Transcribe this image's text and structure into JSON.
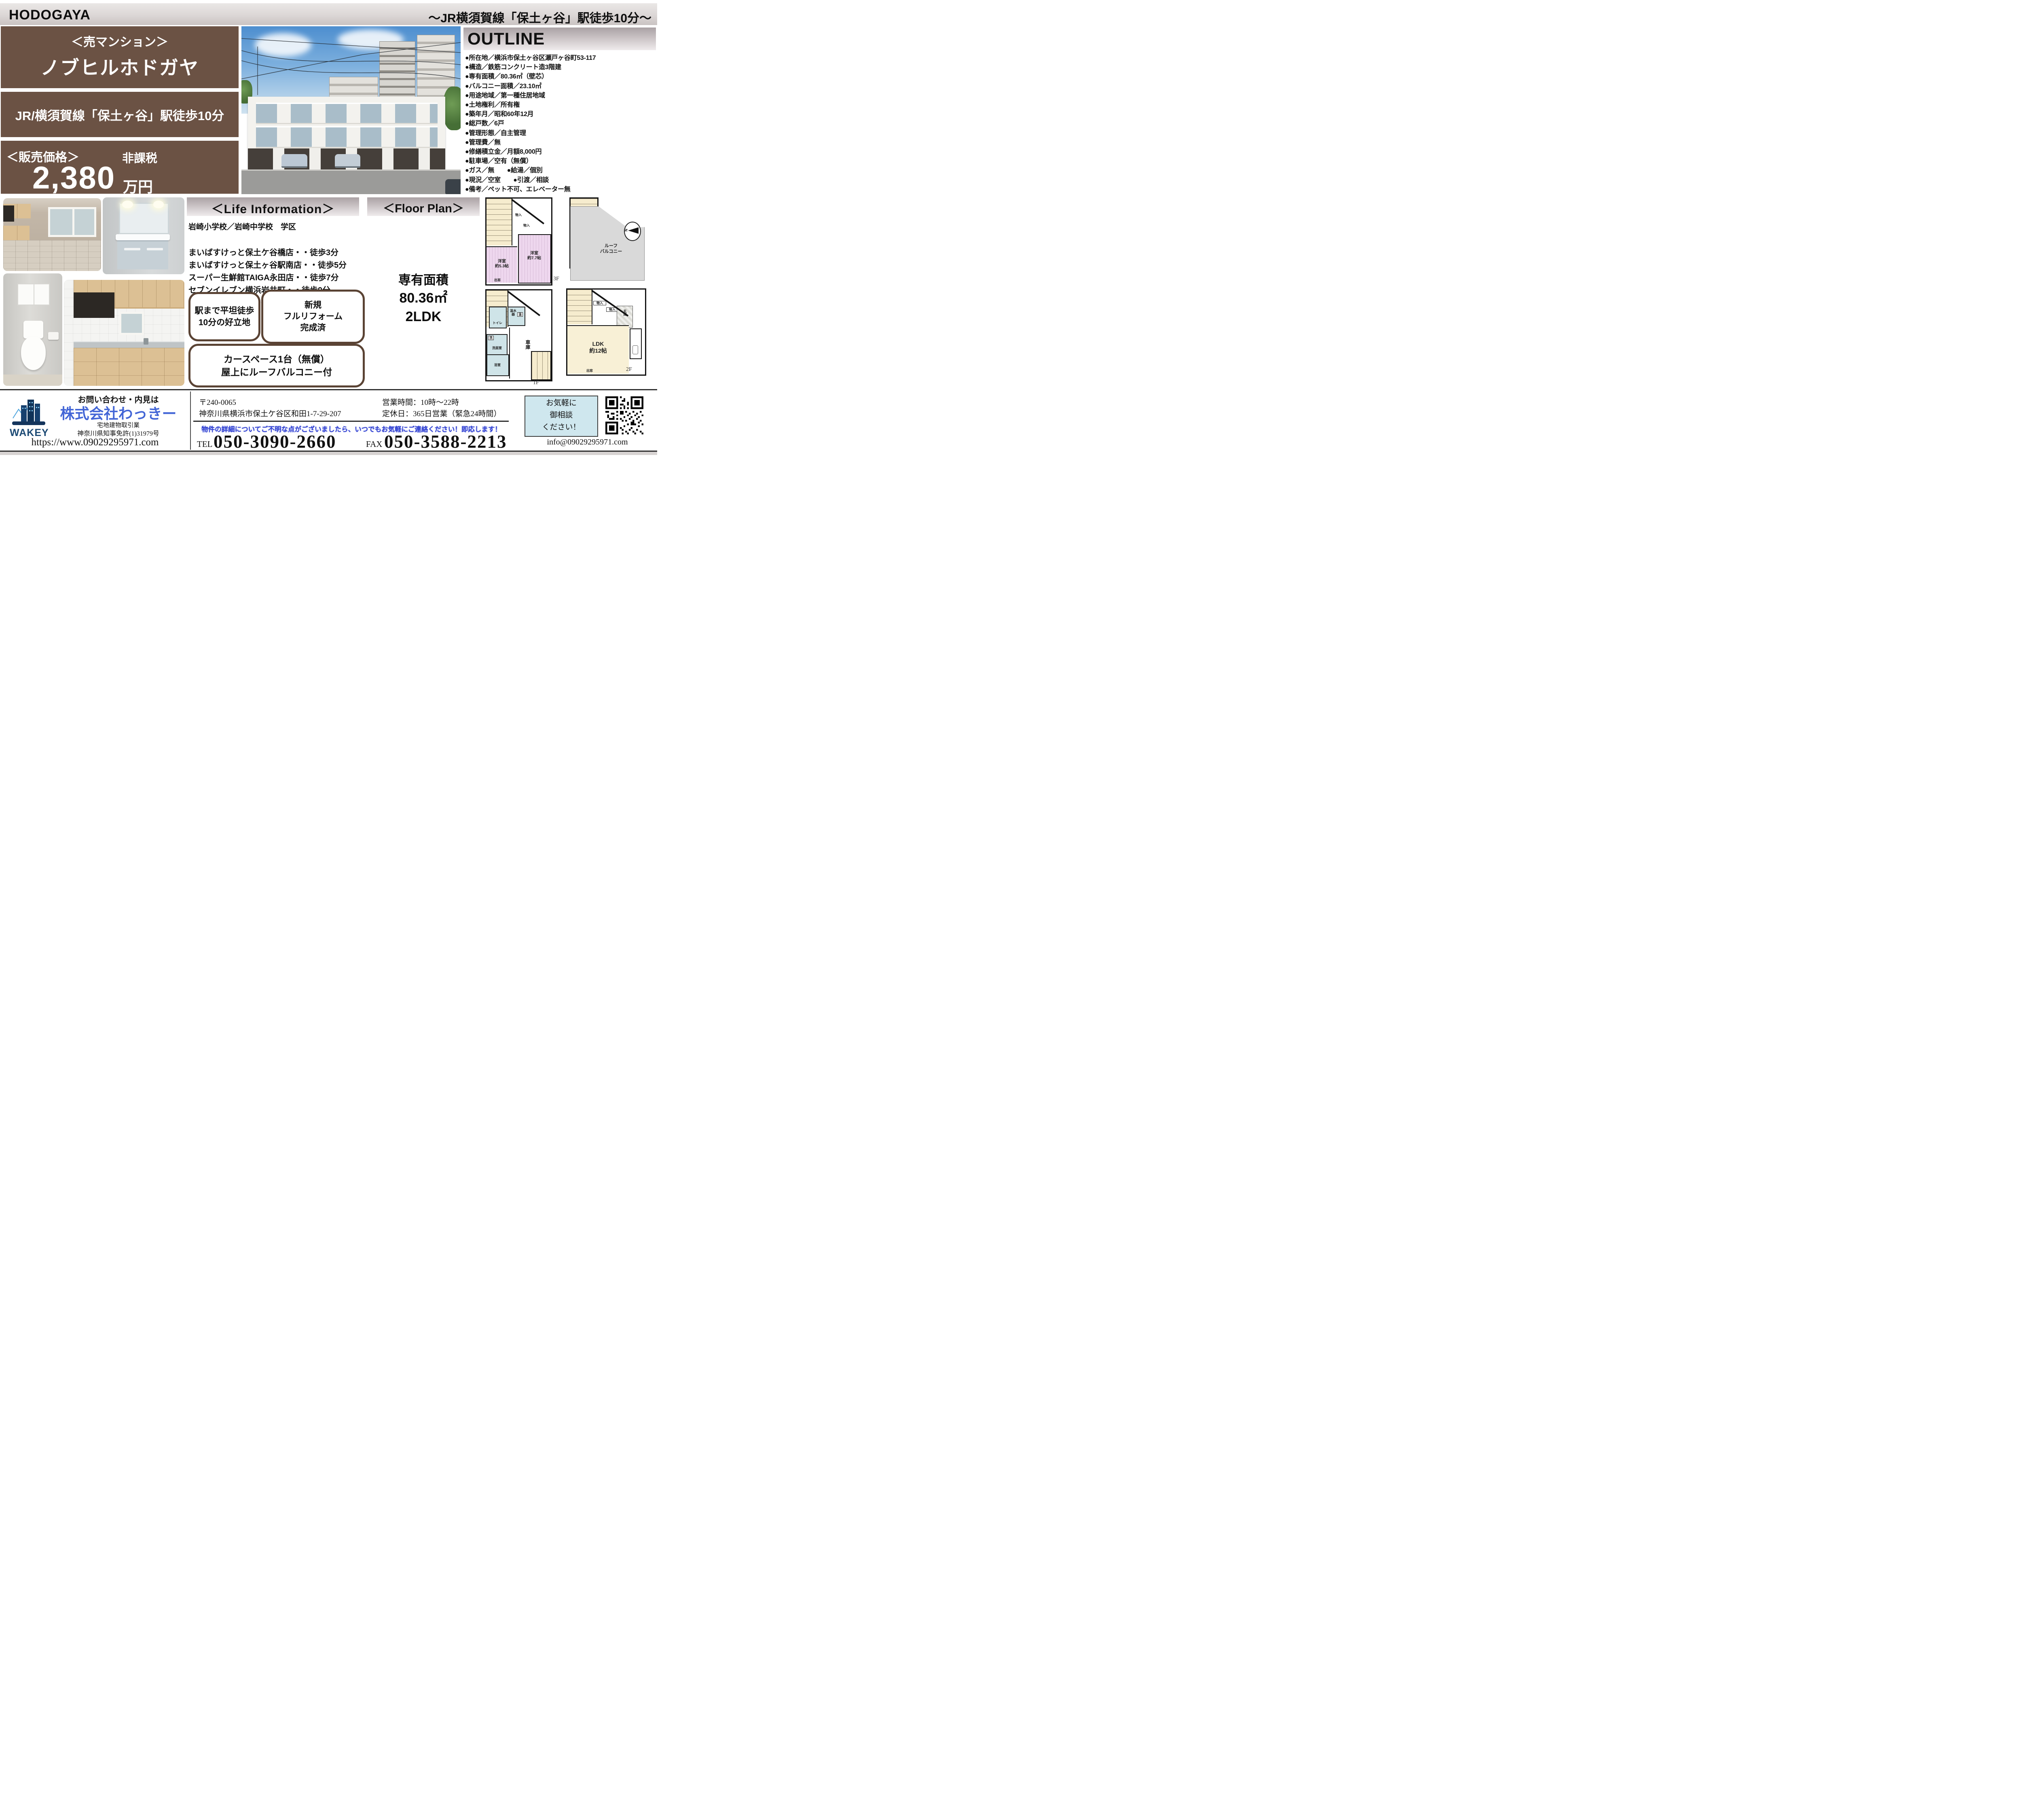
{
  "header": {
    "brand": "HODOGAYA",
    "station_note": "～JR横須賀線「保土ヶ谷」駅徒歩10分～"
  },
  "property": {
    "type_label": "＜売マンション＞",
    "name": "ノブヒルホドガヤ",
    "access": "JR/横須賀線「保土ヶ谷」駅徒歩10分",
    "price_label": "＜販売価格＞",
    "tax_note": "非課税",
    "price_value": "2,380",
    "price_unit": "万円"
  },
  "outline": {
    "title": "OUTLINE",
    "items": [
      "●所在地／横浜市保土ヶ谷区瀬戸ヶ谷町53-117",
      "●構造／鉄筋コンクリート造3階建",
      "●専有面積／80.36㎡（壁芯）",
      "●バルコニー面積／23.10㎡",
      "●用途地域／第一種住居地域",
      "●土地権利／所有権",
      "●築年月／昭和60年12月",
      "●総戸数／6戸",
      "●管理形態／自主管理",
      "●管理費／無",
      "●修繕積立金／月額8,000円",
      "●駐車場／空有（無償）",
      "●ガス／無　　●給湯／個別",
      "●現況／空室　　●引渡／相談",
      "●備考／ペット不可、エレベーター無"
    ]
  },
  "life_info": {
    "title": "＜Life Information＞",
    "school_district": "岩崎小学校／岩崎中学校　学区",
    "places": [
      "まいばすけっと保土ケ谷橋店・・徒歩3分",
      "まいばすけっと保土ヶ谷駅南店・・徒歩5分",
      "スーパー生鮮館TAIGA永田店・・徒歩7分",
      "セブンイレブン横浜岩井町・・徒歩9分",
      "ダイアナ保育園・・徒歩9分"
    ],
    "feature1": {
      "line1": "駅まで平坦徒歩",
      "line2": "10分の好立地"
    },
    "feature2": {
      "line1": "新規",
      "line2": "フルリフォーム",
      "line3": "完成済"
    },
    "feature3": {
      "line1": "カースペース1台（無償）",
      "line2": "屋上にルーフバルコニー付"
    }
  },
  "floor_plan": {
    "title": "＜Floor Plan＞",
    "area_title": "専有面積",
    "area_value": "80.36㎡",
    "layout_type": "2LDK",
    "compass_n": "N",
    "f3": {
      "room1": "洋室",
      "room1_size": "約5.3帖",
      "room2": "洋室",
      "room2_size": "約7.7帖",
      "closet1": "物入",
      "closet2": "物入",
      "bay_window": "出窓",
      "label": "3F"
    },
    "roof": {
      "line1": "ルーフ",
      "line2": "バルコニー"
    },
    "f2": {
      "closet1": "物入",
      "closet2": "物入",
      "entrance": "玄関",
      "room": "LDK",
      "room_size": "約12帖",
      "bay_window": "出窓",
      "label": "2F"
    },
    "f1": {
      "toilet": "トイレ",
      "heater": "温水器",
      "heater_mark": "温",
      "wash": "洗",
      "washroom": "洗面室",
      "bath": "浴室",
      "garage": "車庫",
      "label": "1F"
    }
  },
  "footer": {
    "contact_lead": "お問い合わせ・内見は",
    "company_name": "株式会社わっきー",
    "logo_text": "WAKEY",
    "business_type": "宅地建物取引業",
    "license": "神奈川県知事免許(1)31979号",
    "website": "https://www.09029295971.com",
    "postal_code": "〒240-0065",
    "address": "神奈川県横浜市保土ケ谷区和田1-7-29-207",
    "hours": "営業時間：10時～22時",
    "holiday": "定休日：365日営業（緊急24時間）",
    "notice": "物件の詳細についてご不明な点がございましたら、いつでもお気軽にご連絡ください！即応します！",
    "tel_label": "TEL",
    "tel": "050-3090-2660",
    "fax_label": "FAX",
    "fax": "050-3588-2213",
    "consult": {
      "line1": "お気軽に",
      "line2": "御相談",
      "line3": "ください！"
    },
    "email": "info@09029295971.com"
  },
  "colors": {
    "brand_brown": "#6b5244",
    "accent_blue": "#4265d6",
    "notice_blue": "#2e3ed0",
    "logo_navy": "#173a63",
    "consult_bg": "#cfe7ee"
  }
}
